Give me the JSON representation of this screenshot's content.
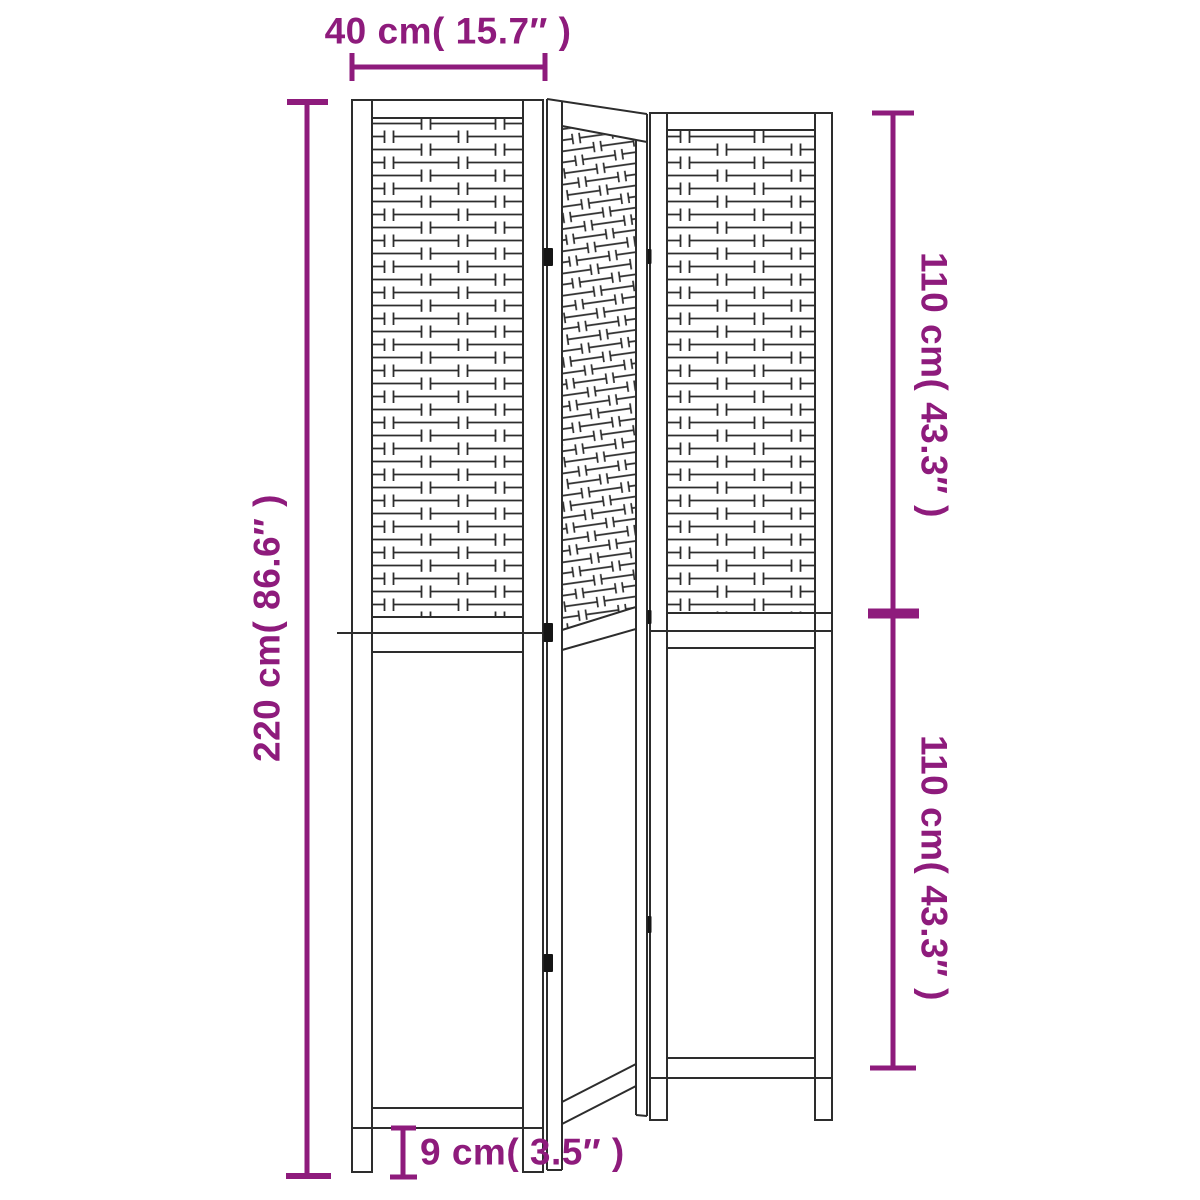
{
  "page": {
    "background": "#ffffff"
  },
  "drawing": {
    "subject": "3-panel folding room divider with woven upper lattice and solid lower panels",
    "panel_count": 3,
    "line_color": "#2d2d2d",
    "hinge_color": "#151515"
  },
  "dimensions": {
    "accent_color": "#8E1B7C",
    "panel_width_label": "40 cm( 15.7″ )",
    "total_height_label": "220 cm( 86.6″ )",
    "upper_section_label": "110 cm( 43.3″ )",
    "lower_section_label": "110 cm( 43.3″ )",
    "foot_height_label": "9 cm( 3.5″ )"
  }
}
